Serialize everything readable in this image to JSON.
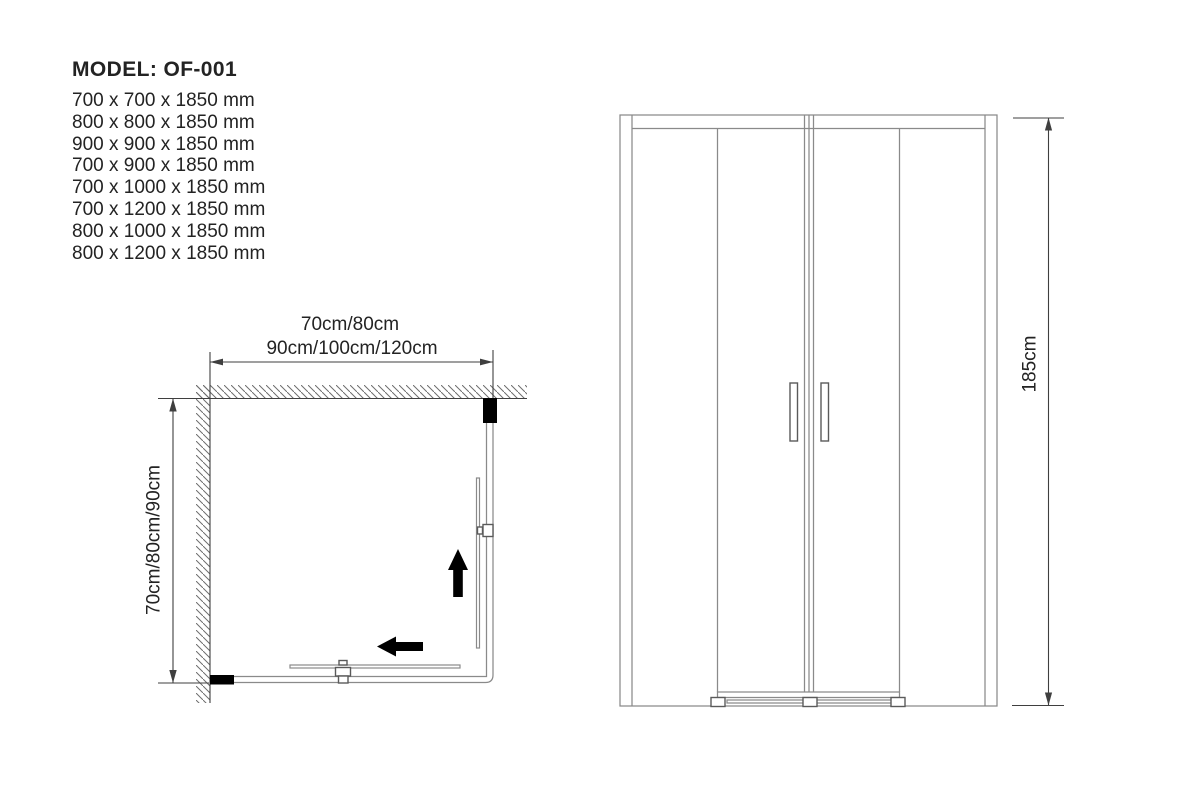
{
  "title": "MODEL: OF-001",
  "sizes": [
    "700 x 700 x 1850 mm",
    "800 x 800 x 1850 mm",
    "900 x 900 x 1850 mm",
    "700 x 900 x 1850 mm",
    "700 x 1000 x 1850 mm",
    "700 x 1200 x 1850 mm",
    "800 x 1000 x 1850 mm",
    "800 x 1200 x 1850 mm"
  ],
  "plan_view": {
    "width_label_line1": "70cm/80cm",
    "width_label_line2": "90cm/100cm/120cm",
    "depth_label": "70cm/80cm/90cm"
  },
  "front_view": {
    "height_label": "185cm"
  },
  "colors": {
    "text": "#232323",
    "frame_line": "#8a8a8a",
    "detail_line": "#5a5a5a",
    "dimension_line": "#3f3f3f",
    "solid_fill": "#000000",
    "hatch": "#6e6e6e"
  }
}
